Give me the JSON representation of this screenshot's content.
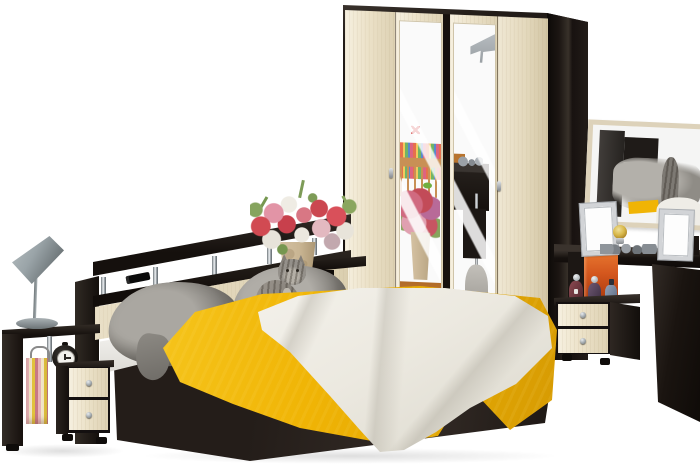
{
  "image": {
    "kind": "product-photo",
    "subject": "bedroom furniture set: wardrobe with mirrored doors, double bed with yellow bedspread, two nightstands, open shelving stands, vanity table with wall mirror, designer lamp, flower bouquet and a cat on the bed",
    "background": "#ffffff"
  },
  "objects": {
    "wardrobe": {
      "doors": 4,
      "mirror_doors": 2,
      "handles": 2
    },
    "bed": {
      "pillows": 2,
      "bedspread": "yellow",
      "throw": "white",
      "cat_on_bed": true
    },
    "left_stand": {
      "items": [
        "designer lamp",
        "striped bag",
        "alarm clock"
      ],
      "nightstand_drawers": 2
    },
    "right_stand": {
      "nightstand_drawers": 2,
      "items": [
        "orange decor panel",
        "perfume bottles"
      ]
    },
    "vanity": {
      "wall_mirror": true,
      "items": [
        "ornate photo frame",
        "gold trinket jar",
        "jewelry",
        "ornate photo frame"
      ]
    },
    "headboard": {
      "shelf": true,
      "chrome_posts": 5,
      "remote_on_shelf": true
    },
    "bouquet": {
      "vase": "tan ceramic",
      "flowers": [
        "red",
        "pink",
        "white"
      ]
    }
  },
  "palette": {
    "bg": "#ffffff",
    "wenge": "#221c18",
    "wenge_dark": "#120d0a",
    "wenge_side": "#332c26",
    "cream": "#ece2c9",
    "panel_cream": "#e9dfc6",
    "mirror_bg": "#fafafa",
    "yellow": "#f0b405",
    "yellow_deep": "#cf9202",
    "throw": "#ece9e0",
    "pillow": "#97948e",
    "pillow_dark": "#767370",
    "chrome": "#c9ced2",
    "silver": "#9aa1a6",
    "lamp_gray": "#9aa4a8",
    "orange_decor": "#d4571e",
    "floor_orange": "#d98f44",
    "vase_tan": "#c9b593",
    "flower_red": "#d14a52",
    "flower_pink": "#e294a6",
    "cat_gray": "#94908a",
    "frame_cream": "#ddd2ba"
  }
}
